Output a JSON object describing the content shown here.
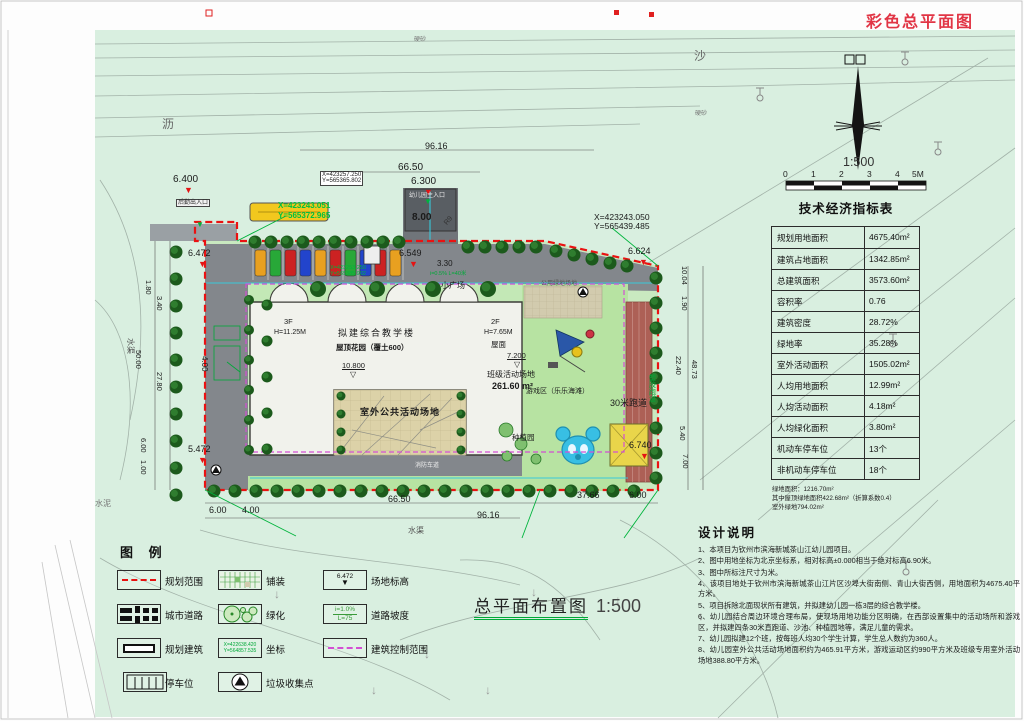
{
  "page_title": "彩色总平面图",
  "drawing_title": {
    "text": "总平面布置图",
    "scale": "1:500"
  },
  "compass": {
    "scale_label": "1:500",
    "ticks": [
      "0",
      "1",
      "2",
      "3",
      "4",
      "5M"
    ]
  },
  "indicators": {
    "title": "技术经济指标表",
    "rows": [
      {
        "label": "规划用地面积",
        "value": "4675.40m²"
      },
      {
        "label": "建筑占地面积",
        "value": "1342.85m²"
      },
      {
        "label": "总建筑面积",
        "value": "3573.60m²"
      },
      {
        "label": "容积率",
        "value": "0.76"
      },
      {
        "label": "建筑密度",
        "value": "28.72%"
      },
      {
        "label": "绿地率",
        "value": "35.28%"
      },
      {
        "label": "室外活动面积",
        "value": "1505.02m²"
      },
      {
        "label": "人均用地面积",
        "value": "12.99m²"
      },
      {
        "label": "人均活动面积",
        "value": "4.18m²"
      },
      {
        "label": "人均绿化面积",
        "value": "3.80m²"
      },
      {
        "label": "机动车停车位",
        "value": "13个"
      },
      {
        "label": "非机动车停车位",
        "value": "18个"
      }
    ],
    "footnotes": [
      "绿地面积：1216.70m²",
      "其中屋顶绿地面积422.68m²（折算系数0.4）",
      "室外绿地794.02m²"
    ]
  },
  "design": {
    "title": "设计说明",
    "notes": [
      "1、本项目为钦州市滨海新城茶山江幼儿园项目。",
      "2、图中用地坐标为北京坐标系，相对标高±0.000相当于绝对标高6.90米。",
      "3、图中所标注尺寸为米。",
      "4、该项目地处于钦州市滨海新城茶山江片区沙埠大街南侧、青山大街西侧，用地面积为4675.40平方米。",
      "5、项目拆除北面现状所有建筑，并拟建幼儿园一栋3层的综合教学楼。",
      "6、幼儿园结合周边环境合理布局，使现场用地功能分区明确，在西部设置集中的活动场所和游戏区，并拟建四条30米直跑道、沙池、种植园地等，满足儿童的需求。",
      "7、幼儿园拟建12个班，按每班人均30个学生计算，学生总人数约为360人。",
      "8、幼儿园室外公共活动场地面积约为465.91平方米，游戏运动区约990平方米及班级专用室外活动场地388.80平方米。"
    ]
  },
  "legend": {
    "title": "图 例",
    "items": [
      {
        "label": "规划范围"
      },
      {
        "label": "铺装"
      },
      {
        "label": "场地标高"
      },
      {
        "label": "城市道路"
      },
      {
        "label": "绿化"
      },
      {
        "label": "道路坡度"
      },
      {
        "label": "规划建筑"
      },
      {
        "label": "坐标"
      },
      {
        "label": "建筑控制范围"
      },
      {
        "label": "停车位"
      },
      {
        "label": "垃圾收集点"
      }
    ],
    "elev_value": "6.472",
    "slope": {
      "line1": "i=1.0%",
      "line2": "L=75"
    },
    "coord": {
      "line1": "X=422638.420",
      "line2": "Y=564857.535"
    }
  },
  "colors": {
    "background_green": "#d9efe0",
    "site_green": "#c9e9c0",
    "road_gray": "#83878c",
    "boundary_red": "#ea1212",
    "control_magenta": "#d34fd3",
    "coord_green": "#00b43c",
    "track_red": "#ad6056",
    "pool_blue": "#38bfe4",
    "sand_yellow": "#e9d54a"
  },
  "plan": {
    "labels": [
      {
        "t": "96.16",
        "x": 425,
        "y": 142,
        "s": 9
      },
      {
        "t": "66.50",
        "x": 398,
        "y": 163,
        "s": 10
      },
      {
        "t": "6.400",
        "x": 173,
        "y": 175,
        "s": 10
      },
      {
        "t": "▼",
        "x": 184,
        "y": 186,
        "s": 9,
        "c": "#e41414"
      },
      {
        "t": "6.300",
        "x": 411,
        "y": 177,
        "s": 10
      },
      {
        "t": "▼",
        "x": 424,
        "y": 188,
        "s": 9,
        "c": "#e41414"
      },
      {
        "t": "▼",
        "x": 424,
        "y": 198,
        "s": 8,
        "c": "#00b43c"
      },
      {
        "t": "8.00",
        "x": 412,
        "y": 213,
        "s": 10,
        "w": 700
      },
      {
        "t": "幼儿园主入口",
        "x": 409,
        "y": 193,
        "s": 6,
        "c": "#e8e8e8",
        "n": "main-entrance-label"
      },
      {
        "t": "后勤出入口",
        "x": 176,
        "y": 199,
        "s": 6,
        "c": "#333",
        "bg": "#f2f2f2",
        "bd": 1,
        "n": "service-entrance-label"
      },
      {
        "t": "▼",
        "x": 196,
        "y": 221,
        "s": 8,
        "c": "#00b43c"
      },
      {
        "t": "R9",
        "x": 443,
        "y": 222,
        "s": 7,
        "r": -50,
        "c": "#333"
      },
      {
        "t": "硬砂",
        "x": 414,
        "y": 37,
        "s": 6,
        "c": "#777"
      },
      {
        "t": "硬砂",
        "x": 695,
        "y": 111,
        "s": 6,
        "c": "#777"
      },
      {
        "t": "沙",
        "x": 694,
        "y": 50,
        "s": 12,
        "c": "#666"
      },
      {
        "t": "沥",
        "x": 162,
        "y": 118,
        "s": 12,
        "c": "#666"
      },
      {
        "t": "X=423257.250\nY=565365.802",
        "x": 320,
        "y": 171,
        "s": 6,
        "c": "#222",
        "bg": "#ffffff",
        "bd": 1,
        "n": "coordinate-label"
      },
      {
        "t": "X=423243.051",
        "x": 278,
        "y": 202,
        "s": 8,
        "c": "#00c040",
        "w": 700,
        "n": "coordinate-label"
      },
      {
        "t": "Y=565372.965",
        "x": 278,
        "y": 212,
        "s": 8,
        "c": "#00c040",
        "w": 700,
        "n": "coordinate-label"
      },
      {
        "t": "X=423253.250\nY=565385.902",
        "x": 330,
        "y": 266,
        "s": 5.5,
        "c": "#00b43c",
        "n": "coordinate-label"
      },
      {
        "t": "X=423243.050\nY=565439.485",
        "x": 594,
        "y": 213,
        "s": 8.5,
        "n": "coordinate-label"
      },
      {
        "t": "6.549",
        "x": 399,
        "y": 249,
        "s": 9
      },
      {
        "t": "▼",
        "x": 409,
        "y": 260,
        "s": 9,
        "c": "#e41414"
      },
      {
        "t": "6.624",
        "x": 628,
        "y": 247,
        "s": 9
      },
      {
        "t": "▼",
        "x": 639,
        "y": 258,
        "s": 9,
        "c": "#e41414"
      },
      {
        "t": "6.472",
        "x": 188,
        "y": 249,
        "s": 9
      },
      {
        "t": "▼",
        "x": 198,
        "y": 260,
        "s": 9,
        "c": "#e41414"
      },
      {
        "t": "5.472",
        "x": 188,
        "y": 445,
        "s": 9
      },
      {
        "t": "▼",
        "x": 198,
        "y": 456,
        "s": 9,
        "c": "#e41414"
      },
      {
        "t": "6.740",
        "x": 629,
        "y": 441,
        "s": 9
      },
      {
        "t": "▼",
        "x": 640,
        "y": 452,
        "s": 9,
        "c": "#e41414"
      },
      {
        "t": "3.30",
        "x": 437,
        "y": 260,
        "s": 8
      },
      {
        "t": "i=0.5% L=40米",
        "x": 430,
        "y": 272,
        "s": 5.5,
        "c": "#00a838"
      },
      {
        "t": "4.00",
        "x": 208,
        "y": 356,
        "s": 8,
        "r": 90
      },
      {
        "t": "6.00",
        "x": 209,
        "y": 506,
        "s": 9
      },
      {
        "t": "4.00",
        "x": 242,
        "y": 506,
        "s": 9
      },
      {
        "t": "66.50",
        "x": 388,
        "y": 495,
        "s": 9
      },
      {
        "t": "96.16",
        "x": 477,
        "y": 511,
        "s": 9
      },
      {
        "t": "37.66",
        "x": 577,
        "y": 491,
        "s": 9
      },
      {
        "t": "6.00",
        "x": 629,
        "y": 491,
        "s": 9
      },
      {
        "t": "水渠",
        "x": 408,
        "y": 527,
        "s": 8,
        "c": "#555"
      },
      {
        "t": "水渠",
        "x": 134,
        "y": 338,
        "s": 8,
        "c": "#555",
        "r": 90
      },
      {
        "t": "水泥",
        "x": 95,
        "y": 500,
        "s": 8,
        "c": "#777"
      },
      {
        "t": "1.80",
        "x": 152,
        "y": 280,
        "s": 7.5,
        "r": 90
      },
      {
        "t": "3.40",
        "x": 163,
        "y": 296,
        "s": 7.5,
        "r": 90
      },
      {
        "t": "50.00",
        "x": 142,
        "y": 350,
        "s": 7.5,
        "r": 90
      },
      {
        "t": "27.80",
        "x": 163,
        "y": 372,
        "s": 7.5,
        "r": 90
      },
      {
        "t": "6.00",
        "x": 147,
        "y": 438,
        "s": 7.5,
        "r": 90
      },
      {
        "t": "1.00",
        "x": 147,
        "y": 460,
        "s": 7.5,
        "r": 90
      },
      {
        "t": "10.04",
        "x": 688,
        "y": 266,
        "s": 7.5,
        "r": 90
      },
      {
        "t": "1.90",
        "x": 688,
        "y": 296,
        "s": 7.5,
        "r": 90
      },
      {
        "t": "22.40",
        "x": 682,
        "y": 356,
        "s": 7.5,
        "r": 90
      },
      {
        "t": "48.73",
        "x": 698,
        "y": 360,
        "s": 7.5,
        "r": 90
      },
      {
        "t": "5.40",
        "x": 686,
        "y": 426,
        "s": 7.5,
        "r": 90
      },
      {
        "t": "7.00",
        "x": 689,
        "y": 454,
        "s": 7.5,
        "r": 90
      },
      {
        "t": "3F",
        "x": 284,
        "y": 318,
        "s": 7.5
      },
      {
        "t": "H=11.25M",
        "x": 274,
        "y": 329,
        "s": 7
      },
      {
        "t": "拟建综合教学楼",
        "x": 338,
        "y": 329,
        "s": 9,
        "ls": 2,
        "n": "building-label"
      },
      {
        "t": "屋顶花园（覆土600）",
        "x": 336,
        "y": 344,
        "s": 7.5,
        "w": 700,
        "n": "roof-garden-label"
      },
      {
        "t": "10.800",
        "x": 342,
        "y": 362,
        "s": 7.5,
        "u": 1
      },
      {
        "t": "▽",
        "x": 350,
        "y": 371,
        "s": 8
      },
      {
        "t": "2F",
        "x": 491,
        "y": 318,
        "s": 7.5
      },
      {
        "t": "H=7.65M",
        "x": 484,
        "y": 329,
        "s": 7
      },
      {
        "t": "屋面",
        "x": 491,
        "y": 341,
        "s": 7.5
      },
      {
        "t": "7.200",
        "x": 507,
        "y": 352,
        "s": 7.5,
        "u": 1
      },
      {
        "t": "▽",
        "x": 514,
        "y": 361,
        "s": 8
      },
      {
        "t": "班级活动场地",
        "x": 487,
        "y": 371,
        "s": 8,
        "n": "class-activity-label"
      },
      {
        "t": "261.60 m²",
        "x": 492,
        "y": 382,
        "s": 9,
        "w": 700
      },
      {
        "t": "小广场",
        "x": 441,
        "y": 282,
        "s": 8,
        "n": "plaza-label"
      },
      {
        "t": "公用绿地场地",
        "x": 541,
        "y": 281,
        "s": 6,
        "c": "#555"
      },
      {
        "t": "室外公共活动场地",
        "x": 360,
        "y": 408,
        "s": 9,
        "w": 700,
        "ls": 1,
        "n": "outdoor-activity-label"
      },
      {
        "t": "游戏区（乐乐海滩）",
        "x": 526,
        "y": 388,
        "s": 7,
        "n": "play-zone-label"
      },
      {
        "t": "种植园",
        "x": 512,
        "y": 434,
        "s": 7.5,
        "n": "planting-garden-label"
      },
      {
        "t": "30米跑道",
        "x": 610,
        "y": 399,
        "s": 9,
        "n": "track-label"
      },
      {
        "t": "塑胶跑道",
        "x": 648,
        "y": 374,
        "s": 7,
        "c": "#00a838",
        "v": 1
      },
      {
        "t": "消防车道",
        "x": 415,
        "y": 463,
        "s": 6,
        "c": "#eeeeee",
        "n": "fire-lane-label"
      },
      {
        "t": "↓",
        "x": 531,
        "y": 586,
        "s": 12,
        "c": "#999"
      },
      {
        "t": "↓",
        "x": 615,
        "y": 594,
        "s": 12,
        "c": "#999"
      },
      {
        "t": "↓",
        "x": 424,
        "y": 648,
        "s": 12,
        "c": "#999"
      },
      {
        "t": "↓",
        "x": 274,
        "y": 588,
        "s": 12,
        "c": "#999"
      },
      {
        "t": "↓",
        "x": 371,
        "y": 684,
        "s": 12,
        "c": "#999"
      },
      {
        "t": "↓",
        "x": 485,
        "y": 684,
        "s": 12,
        "c": "#999"
      },
      {
        "t": "↓",
        "x": 698,
        "y": 610,
        "s": 12,
        "c": "#999"
      }
    ]
  }
}
